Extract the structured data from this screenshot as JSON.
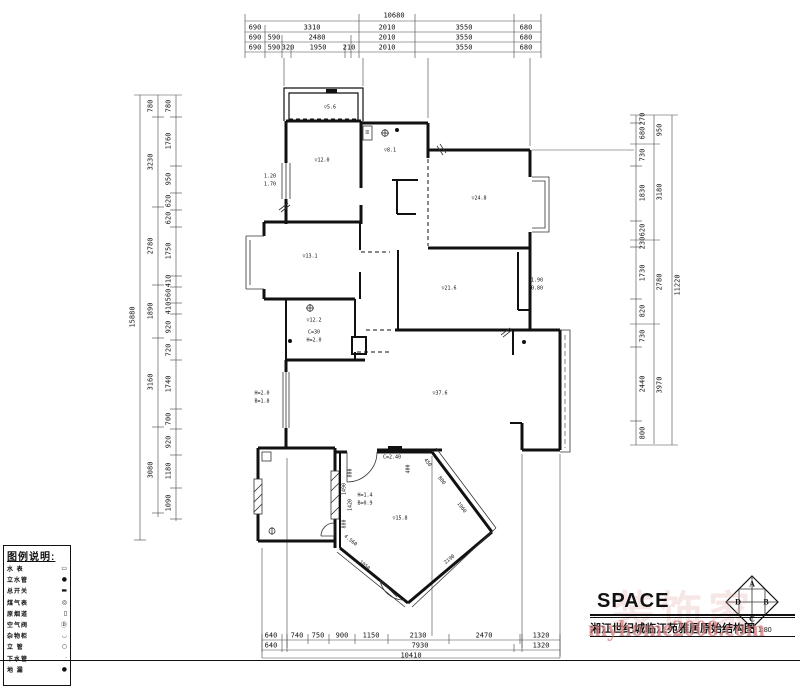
{
  "sheet": {
    "background": "#ffffff",
    "line_color": "#111111",
    "watermark_color": "#cd7878"
  },
  "title_block": {
    "brand": "SPACE",
    "drawing_title": "湘江世纪城临江苑雅居原始结构图",
    "scale": "1:80",
    "watermark": "myhome2008.com",
    "watermark2": "装饰家",
    "logo": [
      "A",
      "B",
      "C",
      "D"
    ]
  },
  "legend": {
    "title": "图例说明:",
    "items": [
      {
        "label": "水 表",
        "symbol": "▭"
      },
      {
        "label": "立水管",
        "symbol": "●"
      },
      {
        "label": "总开关",
        "symbol": "▬"
      },
      {
        "label": "煤气表",
        "symbol": "◎"
      },
      {
        "label": "原烟道",
        "symbol": "▯"
      },
      {
        "label": "空气阀",
        "symbol": "Ⓓ"
      },
      {
        "label": "杂物柜",
        "symbol": "◡"
      },
      {
        "label": "立 管",
        "symbol": "○"
      },
      {
        "label": "下水管",
        "symbol": "·"
      },
      {
        "label": "地 漏",
        "symbol": "●"
      }
    ]
  },
  "dimensions": {
    "top": {
      "total": {
        "t": "10680",
        "x": 394,
        "y": 16
      },
      "row1": [
        {
          "t": "690",
          "x": 255,
          "y": 28
        },
        {
          "t": "3310",
          "x": 312,
          "y": 28
        },
        {
          "t": "2010",
          "x": 387,
          "y": 28
        },
        {
          "t": "3550",
          "x": 464,
          "y": 28
        },
        {
          "t": "680",
          "x": 526,
          "y": 28
        }
      ],
      "row2": [
        {
          "t": "690",
          "x": 255,
          "y": 38
        },
        {
          "t": "590",
          "x": 274,
          "y": 38
        },
        {
          "t": "2480",
          "x": 317,
          "y": 38
        },
        {
          "t": "2010",
          "x": 387,
          "y": 38
        },
        {
          "t": "3550",
          "x": 464,
          "y": 38
        },
        {
          "t": "680",
          "x": 526,
          "y": 38
        }
      ],
      "row3": [
        {
          "t": "690",
          "x": 255,
          "y": 48
        },
        {
          "t": "590",
          "x": 274,
          "y": 48
        },
        {
          "t": "320",
          "x": 288,
          "y": 48
        },
        {
          "t": "1950",
          "x": 318,
          "y": 48
        },
        {
          "t": "210",
          "x": 349,
          "y": 48
        },
        {
          "t": "2010",
          "x": 387,
          "y": 48
        },
        {
          "t": "3550",
          "x": 464,
          "y": 48
        },
        {
          "t": "680",
          "x": 526,
          "y": 48
        }
      ]
    },
    "left": {
      "total": {
        "t": "15880",
        "x": 133,
        "y": 317,
        "r": -90
      },
      "mid": [
        {
          "t": "780",
          "x": 151,
          "y": 106,
          "r": -90
        },
        {
          "t": "3230",
          "x": 151,
          "y": 162,
          "r": -90
        },
        {
          "t": "2780",
          "x": 151,
          "y": 246,
          "r": -90
        },
        {
          "t": "1890",
          "x": 151,
          "y": 311,
          "r": -90
        },
        {
          "t": "3160",
          "x": 151,
          "y": 382,
          "r": -90
        },
        {
          "t": "3080",
          "x": 151,
          "y": 470,
          "r": -90
        }
      ],
      "inner": [
        {
          "t": "780",
          "x": 169,
          "y": 106,
          "r": -90
        },
        {
          "t": "1760",
          "x": 169,
          "y": 141,
          "r": -90
        },
        {
          "t": "950",
          "x": 169,
          "y": 179,
          "r": -90
        },
        {
          "t": "620",
          "x": 169,
          "y": 201,
          "r": -90
        },
        {
          "t": "620",
          "x": 169,
          "y": 218,
          "r": -90
        },
        {
          "t": "1750",
          "x": 169,
          "y": 251,
          "r": -90
        },
        {
          "t": "410",
          "x": 169,
          "y": 281,
          "r": -90
        },
        {
          "t": "560",
          "x": 169,
          "y": 295,
          "r": -90
        },
        {
          "t": "410",
          "x": 169,
          "y": 308,
          "r": -90
        },
        {
          "t": "920",
          "x": 169,
          "y": 327,
          "r": -90
        },
        {
          "t": "720",
          "x": 169,
          "y": 350,
          "r": -90
        },
        {
          "t": "1740",
          "x": 169,
          "y": 384,
          "r": -90
        },
        {
          "t": "700",
          "x": 169,
          "y": 419,
          "r": -90
        },
        {
          "t": "920",
          "x": 169,
          "y": 442,
          "r": -90
        },
        {
          "t": "1180",
          "x": 169,
          "y": 471,
          "r": -90
        },
        {
          "t": "1090",
          "x": 169,
          "y": 503,
          "r": -90
        }
      ]
    },
    "right": {
      "total": {
        "t": "11220",
        "x": 678,
        "y": 285,
        "r": -90
      },
      "mid": [
        {
          "t": "950",
          "x": 660,
          "y": 130,
          "r": -90
        },
        {
          "t": "3180",
          "x": 660,
          "y": 192,
          "r": -90
        },
        {
          "t": "2780",
          "x": 660,
          "y": 282,
          "r": -90
        },
        {
          "t": "3970",
          "x": 660,
          "y": 385,
          "r": -90
        }
      ],
      "inner": [
        {
          "t": "270",
          "x": 643,
          "y": 119,
          "r": -90
        },
        {
          "t": "680",
          "x": 643,
          "y": 133,
          "r": -90
        },
        {
          "t": "730",
          "x": 643,
          "y": 155,
          "r": -90
        },
        {
          "t": "1830",
          "x": 643,
          "y": 193,
          "r": -90
        },
        {
          "t": "620",
          "x": 643,
          "y": 230,
          "r": -90
        },
        {
          "t": "230",
          "x": 643,
          "y": 243,
          "r": -90
        },
        {
          "t": "1730",
          "x": 643,
          "y": 273,
          "r": -90
        },
        {
          "t": "820",
          "x": 643,
          "y": 311,
          "r": -90
        },
        {
          "t": "730",
          "x": 643,
          "y": 336,
          "r": -90
        },
        {
          "t": "2440",
          "x": 643,
          "y": 384,
          "r": -90
        },
        {
          "t": "800",
          "x": 643,
          "y": 433,
          "r": -90
        }
      ]
    },
    "bottom": {
      "row1": [
        {
          "t": "640",
          "x": 271,
          "y": 636
        },
        {
          "t": "740",
          "x": 297,
          "y": 636
        },
        {
          "t": "750",
          "x": 318,
          "y": 636
        },
        {
          "t": "900",
          "x": 342,
          "y": 636
        },
        {
          "t": "1150",
          "x": 371,
          "y": 636
        },
        {
          "t": "2130",
          "x": 418,
          "y": 636
        },
        {
          "t": "2470",
          "x": 484,
          "y": 636
        },
        {
          "t": "1320",
          "x": 541,
          "y": 636
        }
      ],
      "row2": [
        {
          "t": "640",
          "x": 271,
          "y": 646
        },
        {
          "t": "7930",
          "x": 420,
          "y": 646
        },
        {
          "t": "1320",
          "x": 541,
          "y": 646
        }
      ],
      "total": {
        "t": "10410",
        "x": 411,
        "y": 656
      }
    }
  },
  "plan_labels": [
    {
      "t": "▽5.6",
      "x": 330,
      "y": 108,
      "s": 5
    },
    {
      "t": "▽12.0",
      "x": 322,
      "y": 161,
      "s": 5
    },
    {
      "t": "▽8.1",
      "x": 390,
      "y": 151,
      "s": 5
    },
    {
      "t": "▽24.8",
      "x": 479,
      "y": 199,
      "s": 5
    },
    {
      "t": "▽13.1",
      "x": 310,
      "y": 257,
      "s": 5
    },
    {
      "t": "▽21.6",
      "x": 449,
      "y": 289,
      "s": 5
    },
    {
      "t": "▽12.2",
      "x": 314,
      "y": 321,
      "s": 5
    },
    {
      "t": "C=30",
      "x": 314,
      "y": 333,
      "s": 5
    },
    {
      "t": "H=2.0",
      "x": 314,
      "y": 341,
      "s": 5
    },
    {
      "t": "▽37.6",
      "x": 440,
      "y": 394,
      "s": 5
    },
    {
      "t": "▽15.8",
      "x": 400,
      "y": 519,
      "s": 5
    },
    {
      "t": "1.20",
      "x": 270,
      "y": 177,
      "s": 5
    },
    {
      "t": "1.70",
      "x": 270,
      "y": 185,
      "s": 5
    },
    {
      "t": "H=2.0",
      "x": 262,
      "y": 394,
      "s": 5
    },
    {
      "t": "B=1.8",
      "x": 262,
      "y": 402,
      "s": 5
    },
    {
      "t": "1.90",
      "x": 537,
      "y": 281,
      "s": 5
    },
    {
      "t": "0.80",
      "x": 537,
      "y": 289,
      "s": 5
    },
    {
      "t": "H=1.4",
      "x": 365,
      "y": 496,
      "s": 5
    },
    {
      "t": "B=0.9",
      "x": 365,
      "y": 504,
      "s": 5
    },
    {
      "t": "C=2.40",
      "x": 392,
      "y": 458,
      "s": 5
    },
    {
      "t": "400",
      "x": 409,
      "y": 469,
      "r": -90,
      "s": 5
    },
    {
      "t": "800",
      "x": 351,
      "y": 473,
      "r": -90,
      "s": 5
    },
    {
      "t": "1420",
      "x": 351,
      "y": 505,
      "r": -90,
      "s": 5
    },
    {
      "t": "450",
      "x": 427,
      "y": 463,
      "r": 53,
      "s": 5
    },
    {
      "t": "800",
      "x": 441,
      "y": 481,
      "r": 53,
      "s": 5
    },
    {
      "t": "1960",
      "x": 461,
      "y": 508,
      "r": 53,
      "s": 5
    },
    {
      "t": "2190",
      "x": 450,
      "y": 560,
      "r": -40,
      "s": 5
    },
    {
      "t": "1050",
      "x": 364,
      "y": 566,
      "r": 38,
      "s": 5
    },
    {
      "t": "4.560",
      "x": 350,
      "y": 541,
      "r": 38,
      "s": 5
    },
    {
      "t": "1490",
      "x": 345,
      "y": 489,
      "r": -90,
      "s": 5
    },
    {
      "t": "880",
      "x": 345,
      "y": 524,
      "r": -90,
      "s": 5
    },
    {
      "t": "00",
      "x": 368,
      "y": 132,
      "r": -90,
      "s": 4
    }
  ]
}
